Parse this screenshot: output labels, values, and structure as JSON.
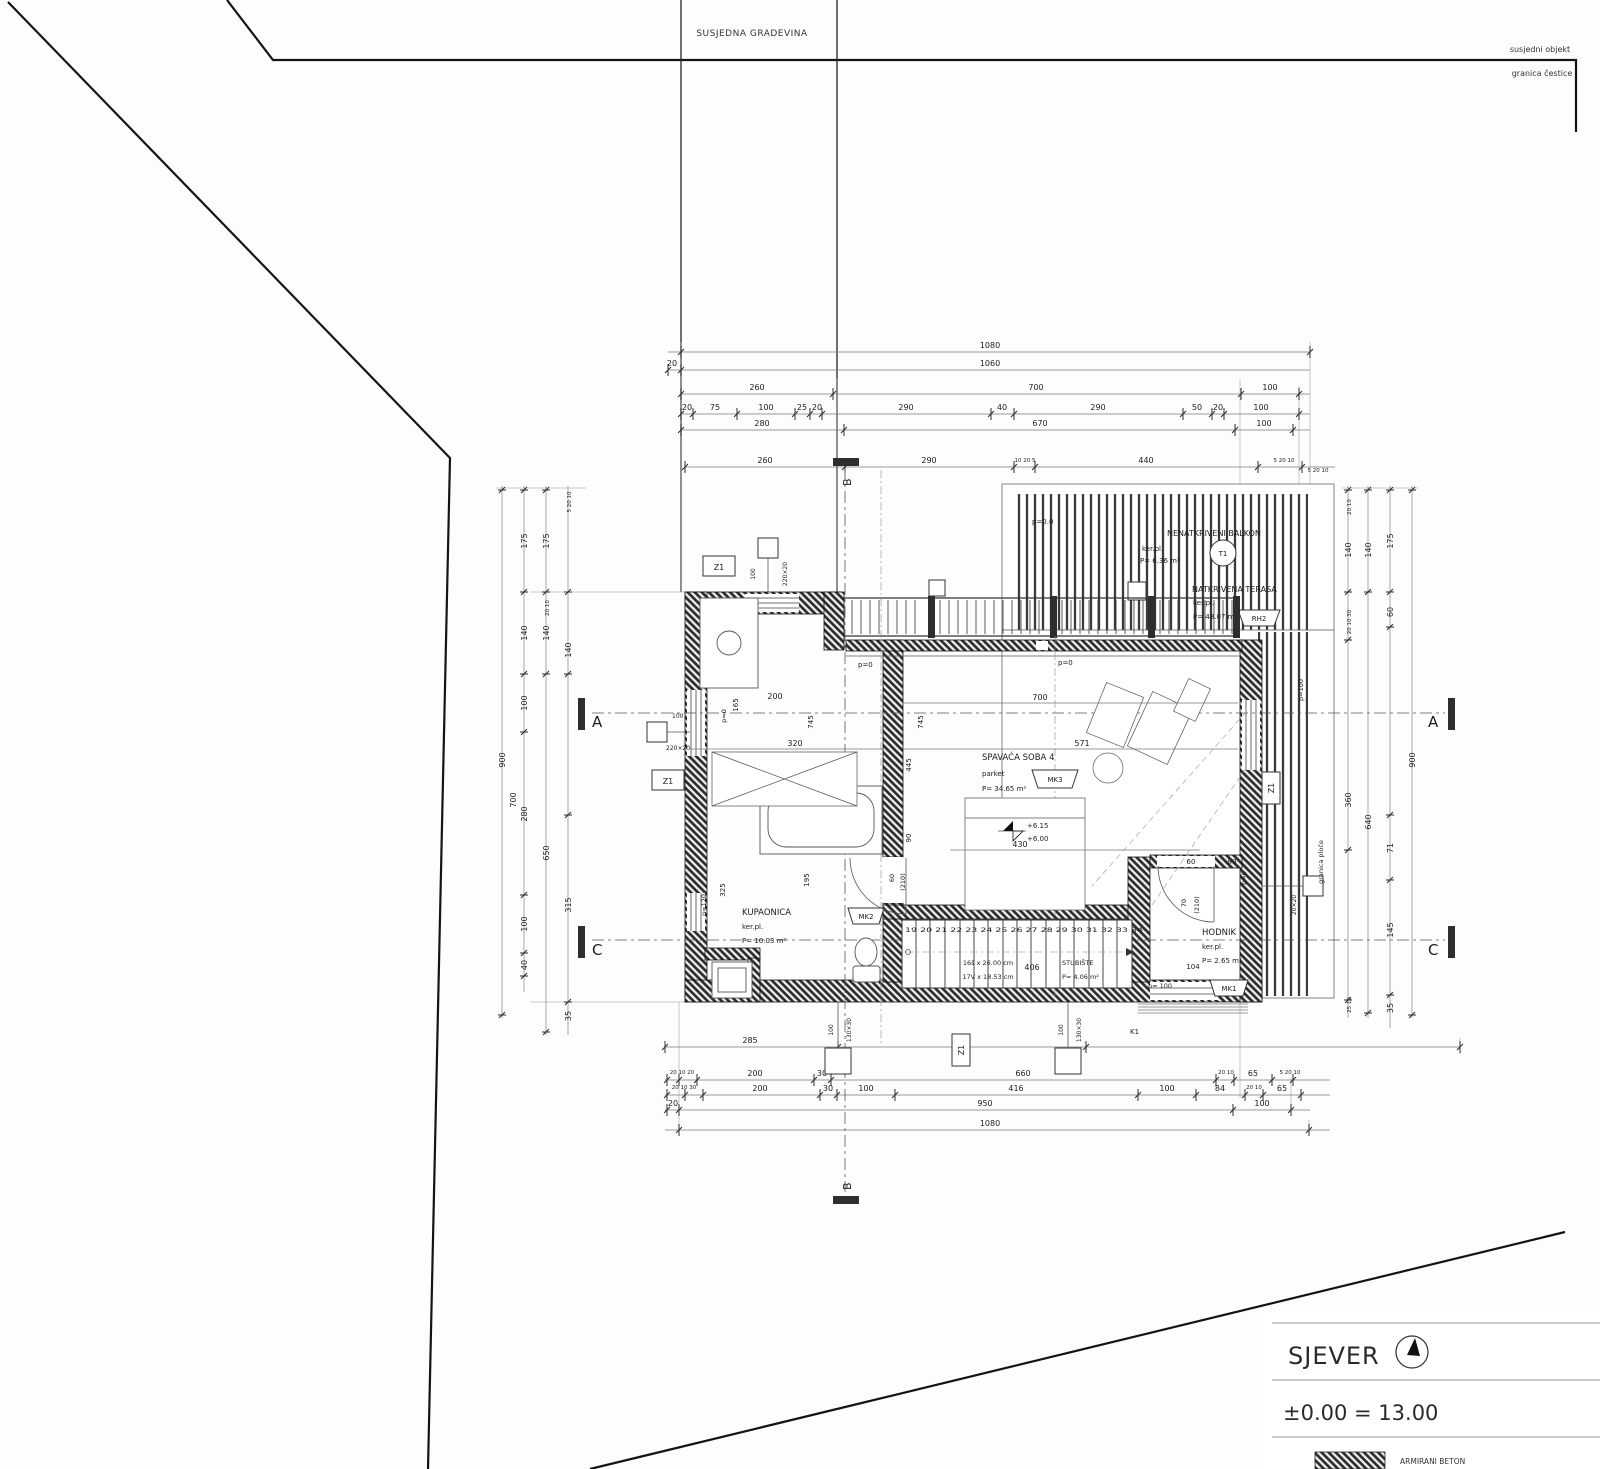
{
  "site": {
    "neighbor_building": "SUSJEDNA GRADEVINA",
    "neighbor_object": "susjedni objekt",
    "parcel_boundary": "granica čestice"
  },
  "legend": {
    "north": "SJEVER",
    "level_eq": "±0.00 = 13.00",
    "material": "ARMIRANI BETON"
  },
  "rooms": {
    "bathroom": {
      "name": "KUPAONICA",
      "floor": "ker.pl.",
      "area": "P= 10.03 m²",
      "badge": "MK2"
    },
    "bedroom": {
      "name": "SPAVAĆA SOBA 4",
      "floor": "parket",
      "area": "P= 34.65 m²",
      "badge": "MK3"
    },
    "hall": {
      "name": "HODNIK",
      "floor": "ker.pl.",
      "area": "P= 2.65 m²",
      "badge": "MK1"
    },
    "stairs": {
      "name": "STUBIŠTE",
      "area": "P= 4.06 m²",
      "line1": "16š x 26.00 cm",
      "line2": "17V x 18.53 cm",
      "numbers": "19 20 21 22 23 24 25 26 27 28 29 30 31 32 33 34",
      "dim": "406"
    },
    "balcony": {
      "name": "NENATKRIVENI BALKON",
      "floor": "ker.pl.",
      "area": "P= 6.36 m²",
      "badge": "T1"
    },
    "terrace": {
      "name": "NATKRIVENA TERASA",
      "floor": "ker.pl.",
      "area": "P= 48.07 m²",
      "badge": "RH2"
    }
  },
  "levels": {
    "upper": "+6.15",
    "lower": "+6.00"
  },
  "markers": {
    "a": "A",
    "b": "B",
    "c": "C",
    "z1": "Z1",
    "k1": "K1"
  },
  "plabels": {
    "p00": "p=0.0",
    "p0": "p=0",
    "p100": "p=100",
    "p100b": "p= 100",
    "p120": "p=120",
    "granica_ploce": "granica ploče"
  },
  "dims": {
    "top": [
      "1080",
      "20",
      "1060",
      "260",
      "700",
      "100",
      "20",
      "75",
      "100",
      "25",
      "20",
      "290",
      "40",
      "290",
      "50",
      "20",
      "100",
      "280",
      "670",
      "100",
      "260",
      "290",
      "10 20 5",
      "440",
      "5 20 10"
    ],
    "bottom": [
      "285",
      "775",
      "20 10 20",
      "200",
      "30",
      "660",
      "20 10",
      "65",
      "5 20 10",
      "20 10 30",
      "200",
      "30",
      "100",
      "416",
      "100",
      "84",
      "20 10",
      "65",
      "20",
      "950",
      "100",
      "1080"
    ],
    "left": [
      "900",
      "700",
      "175",
      "140",
      "100",
      "280",
      "100",
      "40",
      "175",
      "140",
      "650",
      "315",
      "140",
      "35",
      "5 20 10",
      "20 10"
    ],
    "right": [
      "900",
      "175",
      "60",
      "71",
      "145",
      "35",
      "140",
      "640",
      "140",
      "360",
      "575",
      "5 20 10",
      "20 10",
      "20 10 30",
      "25 10"
    ],
    "inner": [
      "200",
      "320",
      "700",
      "571",
      "430",
      "406",
      "104",
      "165",
      "745",
      "745",
      "445",
      "90",
      "325",
      "195",
      "60",
      "80"
    ],
    "doors": [
      "60",
      "(210)",
      "70",
      "(210)"
    ],
    "cols": [
      "100",
      "220×20",
      "100",
      "220×20",
      "100",
      "130×30",
      "100",
      "130×30",
      "20×20"
    ]
  }
}
